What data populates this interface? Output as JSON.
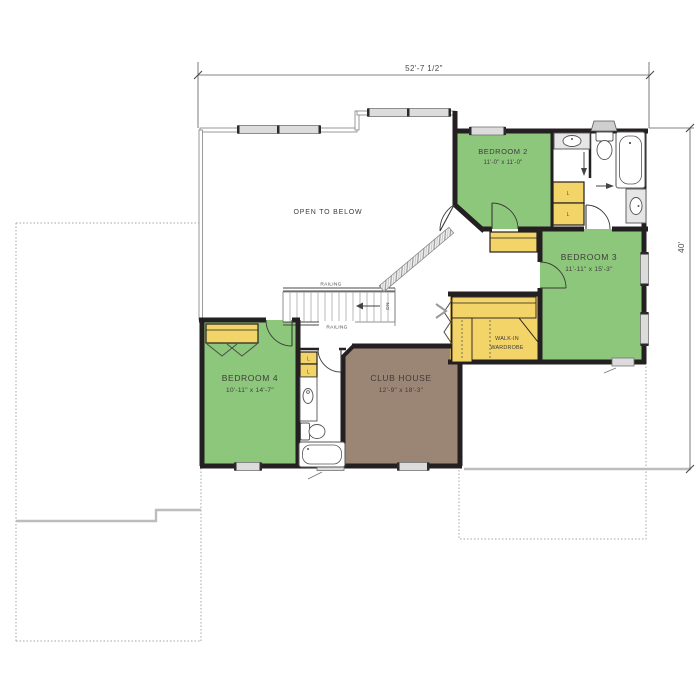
{
  "colors": {
    "room_green": "#8dc77c",
    "closet_yellow": "#f3d469",
    "clubhouse_brown": "#9b8676",
    "wall_black": "#241f20",
    "outline_gray": "#aeaeae"
  },
  "dimensions": {
    "width_total": "52'-7 1/2\"",
    "height_total": "40'"
  },
  "labels": {
    "open_to_below": "OPEN TO BELOW",
    "railing": "RAILING",
    "down": "DN",
    "linen": "L",
    "walk_in_line1": "WALK-IN",
    "walk_in_line2": "WARDROBE"
  },
  "rooms": {
    "bedroom2": {
      "name": "BEDROOM 2",
      "size": "11'-0\" x 11'-0\""
    },
    "bedroom3": {
      "name": "BEDROOM 3",
      "size": "11'-11\" x 15'-3\""
    },
    "bedroom4": {
      "name": "BEDROOM 4",
      "size": "10'-11\" x 14'-7\""
    },
    "club_house": {
      "name": "CLUB HOUSE",
      "size": "12'-9\" x 18'-3\""
    }
  }
}
